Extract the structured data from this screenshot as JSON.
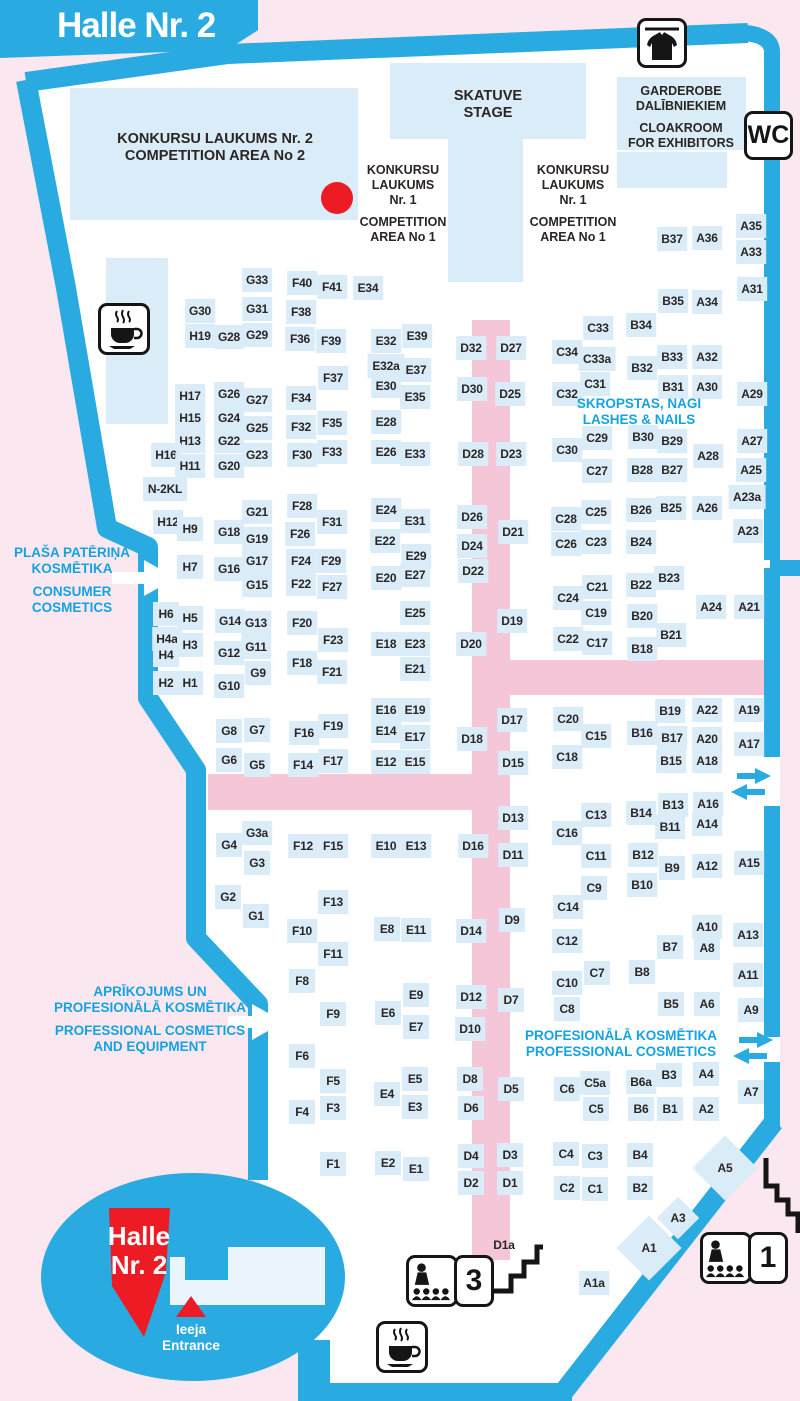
{
  "banner": {
    "title": "Halle Nr. 2"
  },
  "colors": {
    "wall_cyan": "#29abe2",
    "booth_blue": "#d9ecf8",
    "aisle_pink": "#f5c6d8",
    "outside_pink": "#fbe7ef",
    "marker_red": "#ed1c24",
    "text_dark": "#2b2523",
    "zone_text_cyan": "#14a3e2",
    "hall_white": "#ffffff"
  },
  "markers": {
    "red_dot": {
      "x": 337,
      "y": 198,
      "color": "#ed1c24"
    }
  },
  "facilities": {
    "wc": {
      "label": "WC"
    },
    "sign_room3": {
      "label": "3",
      "icon": "lecture-audience-icon"
    },
    "sign_room1": {
      "label": "1",
      "icon": "lecture-audience-icon"
    },
    "icons": [
      "coat-check-icon",
      "coffee-icon-top",
      "coffee-icon-bottom",
      "stairs-icon-room3",
      "stairs-icon-room1",
      "two-way-arrow-icon-upper",
      "two-way-arrow-icon-lower",
      "entrance-arrow-consumer",
      "entrance-arrow-professional"
    ]
  },
  "textblocks": [
    {
      "id": "competition-area-2",
      "x": 215,
      "y": 131,
      "cls": "t-dark-lg",
      "lines": [
        "KONKURSU LAUKUMS Nr. 2",
        "COMPETITION AREA No 2"
      ]
    },
    {
      "id": "stage",
      "x": 488,
      "y": 88,
      "cls": "t-dark-lg",
      "lines": [
        "SKATUVE",
        "STAGE"
      ]
    },
    {
      "id": "competition-area-1-left",
      "x": 403,
      "y": 163,
      "cls": "t-dark-md",
      "lines": [
        "KONKURSU",
        "LAUKUMS",
        "Nr. 1",
        "COMPETITION",
        "AREA No 1"
      ],
      "gap_after": 2
    },
    {
      "id": "competition-area-1-right",
      "x": 573,
      "y": 163,
      "cls": "t-dark-md",
      "lines": [
        "KONKURSU",
        "LAUKUMS",
        "Nr. 1",
        "COMPETITION",
        "AREA No 1"
      ],
      "gap_after": 2
    },
    {
      "id": "garderobe",
      "x": 681,
      "y": 84,
      "cls": "t-dark-md",
      "lines": [
        "GARDEROBE",
        "DALĪBNIEKIEM",
        "CLOAKROOM",
        "FOR EXHIBITORS"
      ],
      "gap_after": 1
    },
    {
      "id": "zone-consumer-cosmetics",
      "x": 72,
      "y": 545,
      "cls": "t-cyan",
      "lines": [
        "PLAŠA PATĒRIŅA",
        "KOSMĒTIKA",
        "CONSUMER",
        "COSMETICS"
      ],
      "gap_after": 1
    },
    {
      "id": "zone-professional-equipment",
      "x": 150,
      "y": 984,
      "cls": "t-cyan",
      "lines": [
        "APRĪKOJUMS UN",
        "PROFESIONĀLĀ KOSMĒTIKA",
        "PROFESSIONAL COSMETICS",
        "AND EQUIPMENT"
      ],
      "gap_after": 1
    },
    {
      "id": "zone-lashes-nails",
      "x": 639,
      "y": 396,
      "cls": "t-cyan",
      "lines": [
        "SKROPSTAS, NAGI",
        "LASHES & NAILS"
      ]
    },
    {
      "id": "zone-professional-cosmetics",
      "x": 621,
      "y": 1028,
      "cls": "t-cyan",
      "lines": [
        "PROFESIONĀLĀ KOSMĒTIKA",
        "PROFESSIONAL COSMETICS"
      ]
    },
    {
      "id": "hall-badge",
      "x": 139,
      "y": 1222,
      "cls": "t-white-xl",
      "lines": [
        "Halle",
        "Nr. 2"
      ]
    },
    {
      "id": "entrance",
      "x": 191,
      "y": 1322,
      "cls": "t-white-sm",
      "lines": [
        "Ieeja",
        "Entrance"
      ]
    }
  ],
  "booths": [
    [
      "G33",
      257,
      280
    ],
    [
      "F40",
      302,
      283
    ],
    [
      "F41",
      332,
      287
    ],
    [
      "E34",
      368,
      288
    ],
    [
      "G30",
      200,
      311
    ],
    [
      "G31",
      257,
      309
    ],
    [
      "F38",
      301,
      312
    ],
    [
      "H19",
      200,
      336
    ],
    [
      "G28",
      229,
      337
    ],
    [
      "G29",
      257,
      335
    ],
    [
      "F36",
      300,
      339
    ],
    [
      "F39",
      331,
      341
    ],
    [
      "E32",
      386,
      341
    ],
    [
      "F37",
      333,
      378
    ],
    [
      "E32a",
      386,
      366
    ],
    [
      "E30",
      386,
      386
    ],
    [
      "E39",
      417,
      336
    ],
    [
      "E37",
      416,
      370
    ],
    [
      "E35",
      415,
      397
    ],
    [
      "D32",
      471,
      348
    ],
    [
      "D27",
      511,
      348
    ],
    [
      "C34",
      567,
      352
    ],
    [
      "C33",
      598,
      328
    ],
    [
      "C33a",
      597,
      359
    ],
    [
      "B34",
      641,
      325
    ],
    [
      "B32",
      642,
      368
    ],
    [
      "B33",
      672,
      357
    ],
    [
      "A32",
      707,
      357
    ],
    [
      "B35",
      673,
      301
    ],
    [
      "A34",
      707,
      302
    ],
    [
      "B37",
      672,
      239
    ],
    [
      "A36",
      707,
      238
    ],
    [
      "A35",
      751,
      226
    ],
    [
      "A33",
      751,
      252
    ],
    [
      "A31",
      752,
      289
    ],
    [
      "D30",
      472,
      389
    ],
    [
      "D25",
      510,
      394
    ],
    [
      "C32",
      567,
      394
    ],
    [
      "C31",
      595,
      384
    ],
    [
      "B31",
      673,
      387
    ],
    [
      "A30",
      707,
      387
    ],
    [
      "A29",
      752,
      394
    ],
    [
      "H17",
      190,
      396
    ],
    [
      "G26",
      229,
      394
    ],
    [
      "G27",
      257,
      400
    ],
    [
      "F34",
      301,
      398
    ],
    [
      "H15",
      190,
      418
    ],
    [
      "G24",
      229,
      418
    ],
    [
      "G25",
      257,
      428
    ],
    [
      "F32",
      301,
      427
    ],
    [
      "F35",
      332,
      423
    ],
    [
      "E28",
      386,
      422
    ],
    [
      "H13",
      190,
      441
    ],
    [
      "G22",
      229,
      441
    ],
    [
      "H16",
      166,
      455
    ],
    [
      "G23",
      257,
      455
    ],
    [
      "F30",
      302,
      455
    ],
    [
      "F33",
      332,
      452
    ],
    [
      "E26",
      386,
      452
    ],
    [
      "H11",
      190,
      466
    ],
    [
      "G20",
      229,
      466
    ],
    [
      "N-2KL",
      165,
      489
    ],
    [
      "C30",
      567,
      450
    ],
    [
      "C29",
      597,
      438
    ],
    [
      "B30",
      643,
      437
    ],
    [
      "B29",
      672,
      441
    ],
    [
      "A28",
      708,
      456
    ],
    [
      "C27",
      597,
      471
    ],
    [
      "B28",
      642,
      470
    ],
    [
      "B27",
      672,
      470
    ],
    [
      "A27",
      752,
      441
    ],
    [
      "A25",
      751,
      470
    ],
    [
      "A23a",
      747,
      497
    ],
    [
      "E33",
      415,
      454
    ],
    [
      "D28",
      473,
      454
    ],
    [
      "D23",
      511,
      454
    ],
    [
      "H12",
      168,
      522
    ],
    [
      "H9",
      190,
      529
    ],
    [
      "G18",
      229,
      532
    ],
    [
      "G21",
      257,
      512
    ],
    [
      "F28",
      302,
      506
    ],
    [
      "F31",
      332,
      522
    ],
    [
      "E24",
      386,
      510
    ],
    [
      "G19",
      257,
      539
    ],
    [
      "F26",
      300,
      534
    ],
    [
      "E22",
      385,
      541
    ],
    [
      "H7",
      190,
      567
    ],
    [
      "G16",
      229,
      569
    ],
    [
      "G17",
      257,
      561
    ],
    [
      "F24",
      301,
      561
    ],
    [
      "F29",
      331,
      561
    ],
    [
      "G15",
      257,
      585
    ],
    [
      "F22",
      301,
      584
    ],
    [
      "F27",
      332,
      587
    ],
    [
      "E20",
      386,
      578
    ],
    [
      "E31",
      415,
      521
    ],
    [
      "D26",
      472,
      517
    ],
    [
      "D21",
      513,
      532
    ],
    [
      "C28",
      566,
      519
    ],
    [
      "C25",
      596,
      512
    ],
    [
      "B26",
      641,
      510
    ],
    [
      "B25",
      671,
      508
    ],
    [
      "A26",
      707,
      508
    ],
    [
      "A23",
      748,
      531
    ],
    [
      "E29",
      416,
      556
    ],
    [
      "D24",
      472,
      546
    ],
    [
      "C26",
      566,
      544
    ],
    [
      "C23",
      596,
      542
    ],
    [
      "B24",
      641,
      542
    ],
    [
      "E27",
      415,
      575
    ],
    [
      "D22",
      473,
      571
    ],
    [
      "C24",
      568,
      598
    ],
    [
      "C21",
      597,
      587
    ],
    [
      "B22",
      641,
      585
    ],
    [
      "B23",
      669,
      578
    ],
    [
      "E25",
      415,
      613
    ],
    [
      "D19",
      512,
      621
    ],
    [
      "C19",
      596,
      613
    ],
    [
      "B20",
      642,
      616
    ],
    [
      "A24",
      711,
      607
    ],
    [
      "A21",
      749,
      607
    ],
    [
      "E23",
      415,
      644
    ],
    [
      "D20",
      471,
      644
    ],
    [
      "C22",
      568,
      639
    ],
    [
      "C17",
      597,
      643
    ],
    [
      "B18",
      642,
      649
    ],
    [
      "B21",
      671,
      635
    ],
    [
      "E21",
      415,
      669
    ],
    [
      "H6",
      166,
      614
    ],
    [
      "H5",
      190,
      618
    ],
    [
      "G14",
      230,
      621
    ],
    [
      "G13",
      256,
      623
    ],
    [
      "F20",
      302,
      623
    ],
    [
      "H4a",
      167,
      639
    ],
    [
      "H3",
      190,
      645
    ],
    [
      "G12",
      229,
      653
    ],
    [
      "G11",
      256,
      647
    ],
    [
      "F18",
      302,
      663
    ],
    [
      "F23",
      333,
      640
    ],
    [
      "E18",
      386,
      644
    ],
    [
      "H4",
      166,
      655
    ],
    [
      "F21",
      332,
      672
    ],
    [
      "G9",
      258,
      673
    ],
    [
      "H2",
      166,
      683
    ],
    [
      "H1",
      190,
      683
    ],
    [
      "G10",
      229,
      686
    ],
    [
      "G8",
      229,
      731
    ],
    [
      "G7",
      257,
      730
    ],
    [
      "F16",
      304,
      733
    ],
    [
      "F19",
      333,
      726
    ],
    [
      "E16",
      386,
      710
    ],
    [
      "E14",
      386,
      731
    ],
    [
      "G6",
      229,
      760
    ],
    [
      "G5",
      257,
      765
    ],
    [
      "F14",
      303,
      765
    ],
    [
      "F17",
      333,
      761
    ],
    [
      "E12",
      386,
      762
    ],
    [
      "E19",
      415,
      710
    ],
    [
      "D17",
      512,
      720
    ],
    [
      "C20",
      568,
      719
    ],
    [
      "B19",
      670,
      711
    ],
    [
      "A22",
      707,
      710
    ],
    [
      "A19",
      749,
      710
    ],
    [
      "E17",
      415,
      737
    ],
    [
      "D18",
      472,
      739
    ],
    [
      "C15",
      596,
      736
    ],
    [
      "B16",
      642,
      733
    ],
    [
      "B17",
      672,
      738
    ],
    [
      "A20",
      707,
      739
    ],
    [
      "A17",
      749,
      744
    ],
    [
      "E15",
      415,
      762
    ],
    [
      "D15",
      513,
      763
    ],
    [
      "C18",
      567,
      757
    ],
    [
      "B15",
      671,
      761
    ],
    [
      "A18",
      707,
      761
    ],
    [
      "B13",
      673,
      805
    ],
    [
      "A16",
      708,
      804
    ],
    [
      "D13",
      513,
      818
    ],
    [
      "C13",
      596,
      815
    ],
    [
      "B14",
      641,
      813
    ],
    [
      "B11",
      670,
      827
    ],
    [
      "A14",
      707,
      824
    ],
    [
      "C16",
      567,
      833
    ],
    [
      "E13",
      416,
      846
    ],
    [
      "D16",
      473,
      846
    ],
    [
      "D11",
      513,
      855
    ],
    [
      "C11",
      596,
      856
    ],
    [
      "B12",
      643,
      855
    ],
    [
      "B9",
      672,
      868
    ],
    [
      "A12",
      707,
      866
    ],
    [
      "A15",
      749,
      863
    ],
    [
      "C9",
      594,
      888
    ],
    [
      "B10",
      642,
      885
    ],
    [
      "C14",
      568,
      907
    ],
    [
      "D9",
      512,
      920
    ],
    [
      "E11",
      416,
      930
    ],
    [
      "D14",
      471,
      931
    ],
    [
      "C12",
      567,
      941
    ],
    [
      "A10",
      707,
      927
    ],
    [
      "A13",
      748,
      935
    ],
    [
      "B7",
      670,
      947
    ],
    [
      "A8",
      707,
      948
    ],
    [
      "G4",
      229,
      845
    ],
    [
      "G3a",
      257,
      833
    ],
    [
      "G3",
      257,
      863
    ],
    [
      "F12",
      303,
      846
    ],
    [
      "F15",
      333,
      846
    ],
    [
      "E10",
      386,
      846
    ],
    [
      "G2",
      228,
      897
    ],
    [
      "G1",
      256,
      916
    ],
    [
      "F13",
      333,
      902
    ],
    [
      "F10",
      302,
      931
    ],
    [
      "E8",
      387,
      929
    ],
    [
      "F11",
      333,
      954
    ],
    [
      "F8",
      302,
      981
    ],
    [
      "F9",
      333,
      1014
    ],
    [
      "E6",
      388,
      1013
    ],
    [
      "F6",
      302,
      1056
    ],
    [
      "F5",
      333,
      1081
    ],
    [
      "F3",
      333,
      1108
    ],
    [
      "E4",
      387,
      1094
    ],
    [
      "F4",
      302,
      1112
    ],
    [
      "F1",
      333,
      1164
    ],
    [
      "E2",
      388,
      1163
    ],
    [
      "C7",
      597,
      973
    ],
    [
      "B8",
      642,
      972
    ],
    [
      "A11",
      748,
      975
    ],
    [
      "E9",
      416,
      995
    ],
    [
      "D12",
      471,
      997
    ],
    [
      "D7",
      511,
      1000
    ],
    [
      "C10",
      567,
      983
    ],
    [
      "B5",
      671,
      1004
    ],
    [
      "A6",
      707,
      1004
    ],
    [
      "A9",
      751,
      1010
    ],
    [
      "E7",
      416,
      1027
    ],
    [
      "D10",
      470,
      1029
    ],
    [
      "C8",
      567,
      1009
    ],
    [
      "E5",
      415,
      1079
    ],
    [
      "D8",
      470,
      1079
    ],
    [
      "D5",
      511,
      1089
    ],
    [
      "C6",
      567,
      1089
    ],
    [
      "C5a",
      595,
      1083
    ],
    [
      "B6a",
      641,
      1082
    ],
    [
      "B3",
      669,
      1075
    ],
    [
      "A4",
      706,
      1074
    ],
    [
      "A7",
      751,
      1092
    ],
    [
      "E3",
      415,
      1107
    ],
    [
      "D6",
      471,
      1108
    ],
    [
      "C5",
      596,
      1109
    ],
    [
      "B6",
      641,
      1109
    ],
    [
      "B1",
      670,
      1109
    ],
    [
      "A2",
      706,
      1109
    ],
    [
      "E1",
      416,
      1169
    ],
    [
      "D4",
      471,
      1156
    ],
    [
      "D3",
      510,
      1155
    ],
    [
      "C4",
      566,
      1154
    ],
    [
      "C3",
      595,
      1156
    ],
    [
      "B4",
      640,
      1155
    ],
    [
      "D2",
      471,
      1183
    ],
    [
      "D1",
      510,
      1183
    ],
    [
      "C2",
      567,
      1188
    ],
    [
      "C1",
      595,
      1189
    ],
    [
      "B2",
      640,
      1188
    ],
    [
      "D1a",
      504,
      1245,
      {
        "c": "nobg"
      }
    ],
    [
      "A1a",
      594,
      1283
    ],
    [
      "A5",
      725,
      1168,
      {
        "w": 46,
        "h": 46,
        "r": 45
      }
    ],
    [
      "A3",
      678,
      1218,
      {
        "w": 30,
        "h": 30,
        "r": 45
      }
    ],
    [
      "A1",
      649,
      1248,
      {
        "w": 46,
        "h": 46,
        "r": 45
      }
    ]
  ]
}
